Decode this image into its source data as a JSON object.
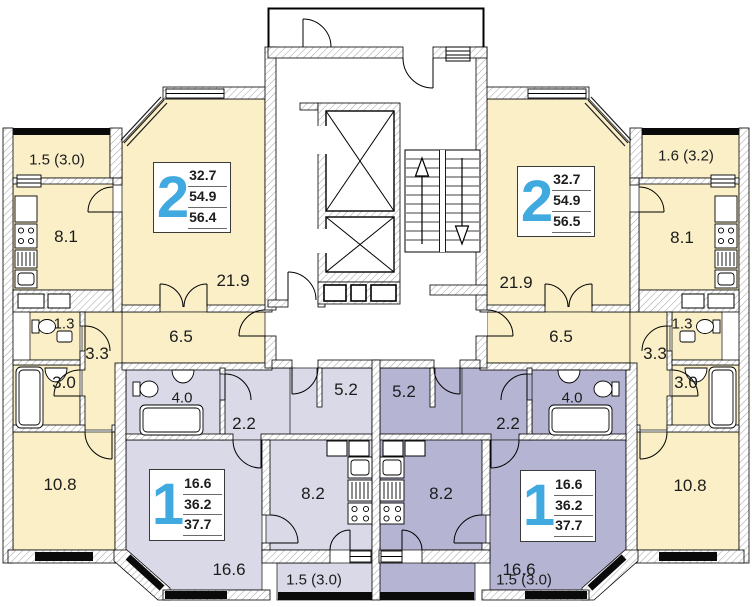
{
  "floorplan": {
    "type": "residential-floor-plan",
    "apartments": {
      "two_room_left": {
        "number": "2",
        "areas": {
          "living": "32.7",
          "usable": "54.9",
          "total": "56.4"
        }
      },
      "two_room_right": {
        "number": "2",
        "areas": {
          "living": "32.7",
          "usable": "54.9",
          "total": "56.5"
        }
      },
      "one_room_left": {
        "number": "1",
        "areas": {
          "living": "16.6",
          "usable": "36.2",
          "total": "37.7"
        }
      },
      "one_room_right": {
        "number": "1",
        "areas": {
          "living": "16.6",
          "usable": "36.2",
          "total": "37.7"
        }
      }
    },
    "room_labels": {
      "balcony_top_left": "1.5 (3.0)",
      "kitchen_left": "8.1",
      "living_room_2_left": "21.9",
      "hallway_left": "6.5",
      "wc_left": "1.3",
      "corridor_left": "3.3",
      "bathroom_left": "3.0",
      "bedroom_left": "10.8",
      "bathroom_1_left": "4.0",
      "hall_1_left": "2.2",
      "corridor_1_left": "5.2",
      "kitchen_1_left": "8.2",
      "living_room_1_left": "16.6",
      "balcony_bottom_left": "1.5 (3.0)",
      "corridor_1_right": "5.2",
      "hall_1_right": "2.2",
      "bathroom_1_right": "4.0",
      "kitchen_1_right": "8.2",
      "living_room_1_right": "16.6",
      "balcony_bottom_right": "1.5 (3.0)",
      "living_room_2_right": "21.9",
      "hallway_right": "6.5",
      "wc_right": "1.3",
      "corridor_right": "3.3",
      "bathroom_right": "3.0",
      "bedroom_right": "10.8",
      "kitchen_right": "8.1",
      "balcony_top_right": "1.6 (3.2)"
    },
    "colors": {
      "two_room_fill": "#faefc7",
      "one_room_left_fill": "#d9d9e7",
      "one_room_right_fill": "#b5b5d3",
      "apartment_number": "#3fa9e0",
      "window": "#0a0a0a"
    }
  }
}
